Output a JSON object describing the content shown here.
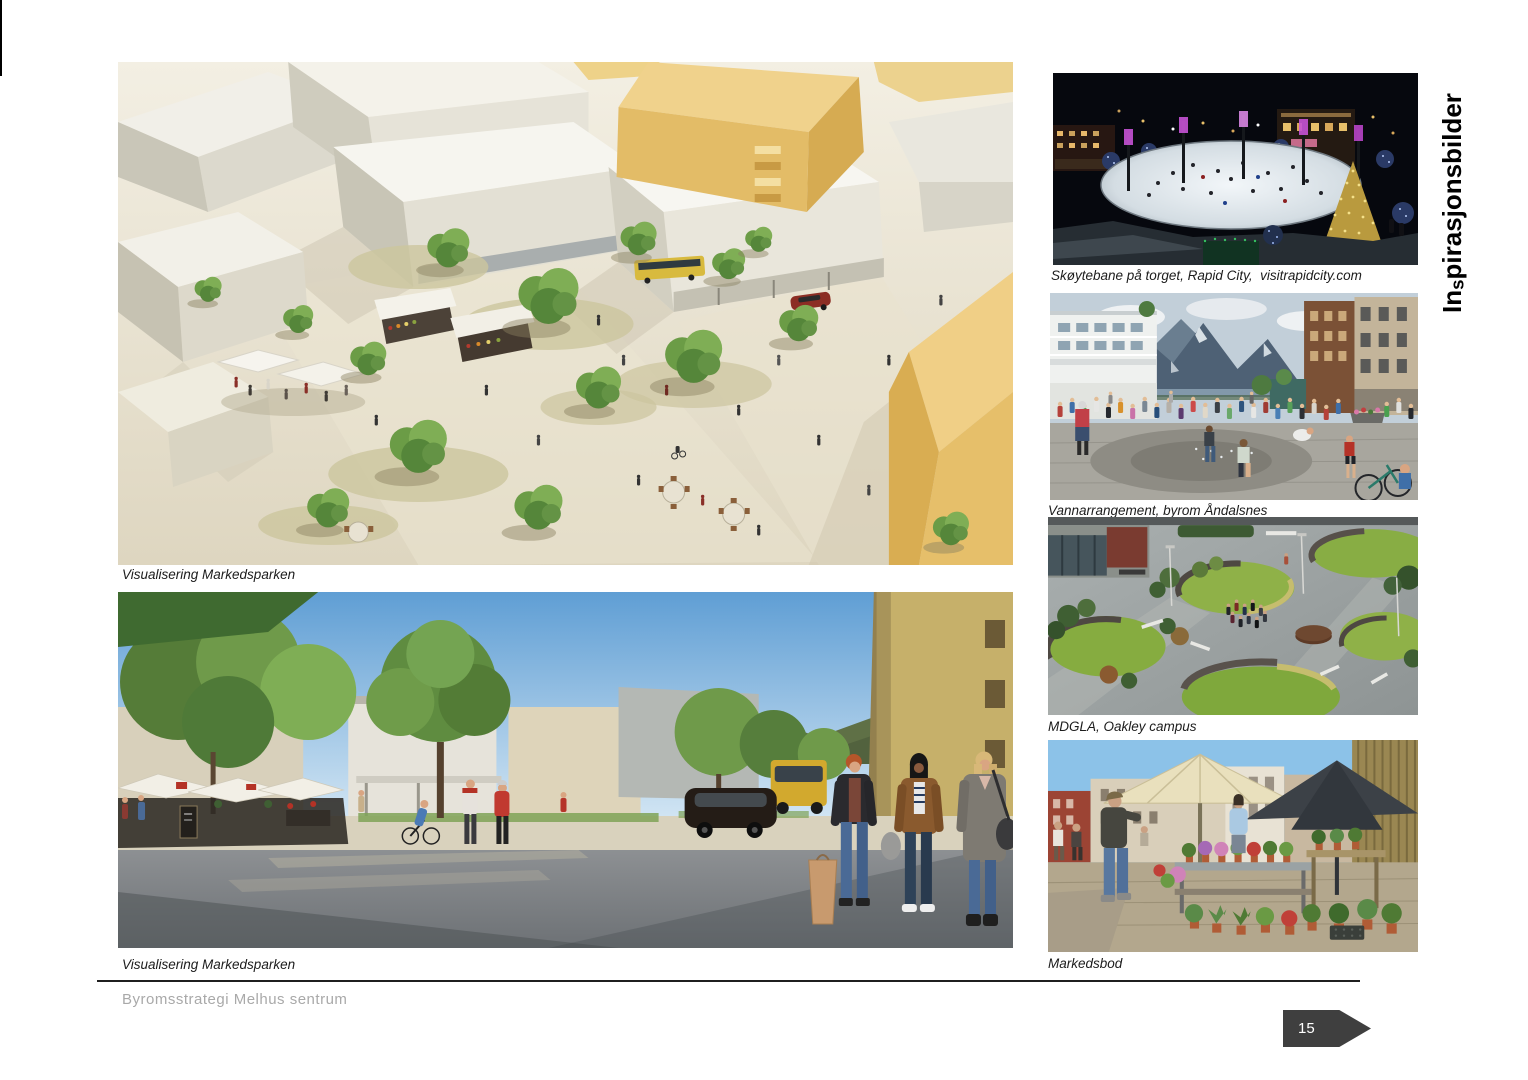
{
  "page_title_vertical": {
    "prefix": "In",
    "s": "s",
    "suffix": "pirasjonsbilder"
  },
  "main_images": {
    "aerial": {
      "caption": "Visualisering Markedsparken"
    },
    "street": {
      "caption": "Visualisering Markedsparken"
    }
  },
  "inspiration_images": [
    {
      "caption": "Skøytebane på torget, Rapid City,  visitrapidcity.com"
    },
    {
      "caption": "Vannarrangement, byrom Åndalsnes"
    },
    {
      "caption": "MDGLA, Oakley campus"
    },
    {
      "caption": "Markedsbod"
    }
  ],
  "footer": {
    "document_title": "Byromsstrategi Melhus sentrum",
    "page_number": "15"
  },
  "colors": {
    "page_arrow_bg": "#3f3f3f",
    "page_arrow_text": "#ffffff",
    "footer_text": "#a9a9a9",
    "footer_rule": "#1f1f1f",
    "caption_text": "#1c1c1c",
    "title_text": "#000000"
  }
}
